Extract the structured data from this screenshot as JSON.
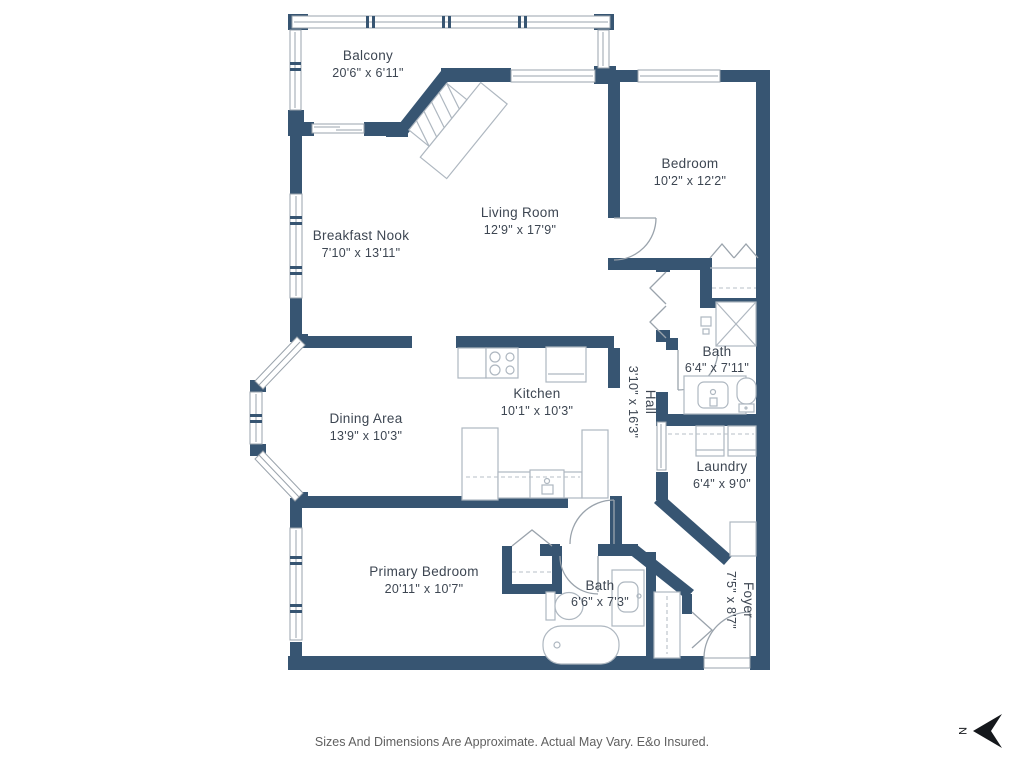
{
  "rooms": {
    "balcony": {
      "name": "Balcony",
      "dims": "20'6\" x 6'11\""
    },
    "breakfast_nook": {
      "name": "Breakfast Nook",
      "dims": "7'10\" x 13'11\""
    },
    "living_room": {
      "name": "Living Room",
      "dims": "12'9\" x 17'9\""
    },
    "bedroom": {
      "name": "Bedroom",
      "dims": "10'2\" x 12'2\""
    },
    "bath_upper": {
      "name": "Bath",
      "dims": "6'4\" x 7'11\""
    },
    "hall": {
      "name": "Hall",
      "dims": "3'10\" x 16'3\""
    },
    "kitchen": {
      "name": "Kitchen",
      "dims": "10'1\" x 10'3\""
    },
    "dining_area": {
      "name": "Dining Area",
      "dims": "13'9\" x 10'3\""
    },
    "laundry": {
      "name": "Laundry",
      "dims": "6'4\" x 9'0\""
    },
    "primary_bedroom": {
      "name": "Primary Bedroom",
      "dims": "20'11\" x 10'7\""
    },
    "bath_lower": {
      "name": "Bath",
      "dims": "6'6\" x 7'3\""
    },
    "foyer": {
      "name": "Foyer",
      "dims": "7'5\" x 8'7\""
    }
  },
  "compass": {
    "label": "N"
  },
  "footer": {
    "disclaimer": "Sizes And Dimensions Are Approximate. Actual May Vary. E&o Insured."
  },
  "colors": {
    "wall": "#375572",
    "fixture_outline": "#aeb7c0",
    "label_text": "#3d4652",
    "footer_text": "#606060",
    "background": "#ffffff",
    "compass_arrow": "#15181c"
  }
}
